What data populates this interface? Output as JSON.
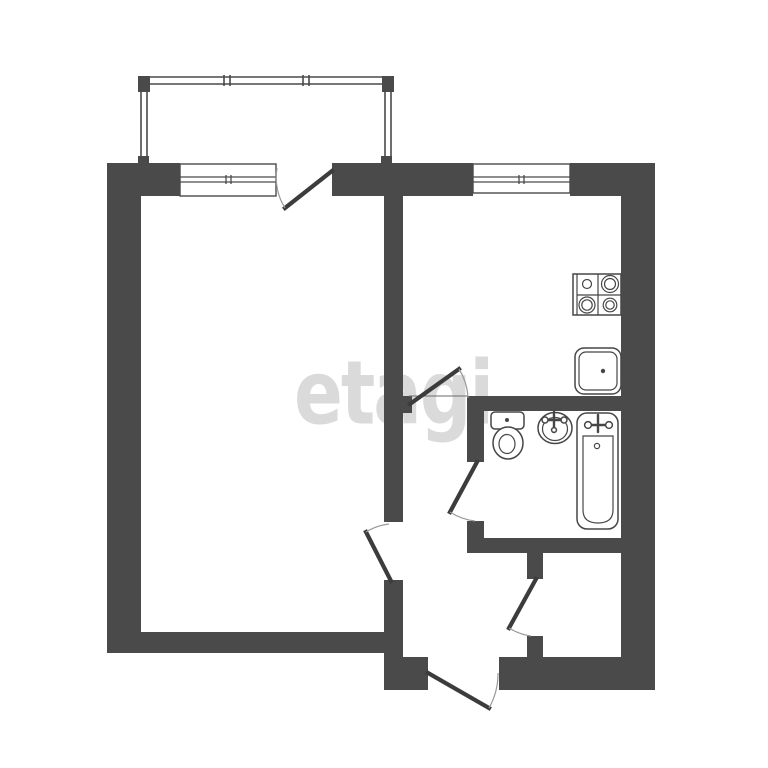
{
  "watermark": {
    "text": "etagi",
    "color": "#dadada"
  },
  "palette": {
    "background": "#ffffff",
    "wall": "#4a4a4a",
    "door_leaf": "#3c3c3c",
    "swing_arc": "#9a9a9a",
    "fixture_outline": "#464646",
    "watermark": "#dadada"
  },
  "plan": {
    "type": "apartment-floor-plan",
    "balcony_glazed": true,
    "window_count": 2,
    "door_count": 6,
    "fixtures": [
      "stove",
      "kitchen-sink",
      "toilet",
      "washbasin",
      "bathtub"
    ]
  }
}
